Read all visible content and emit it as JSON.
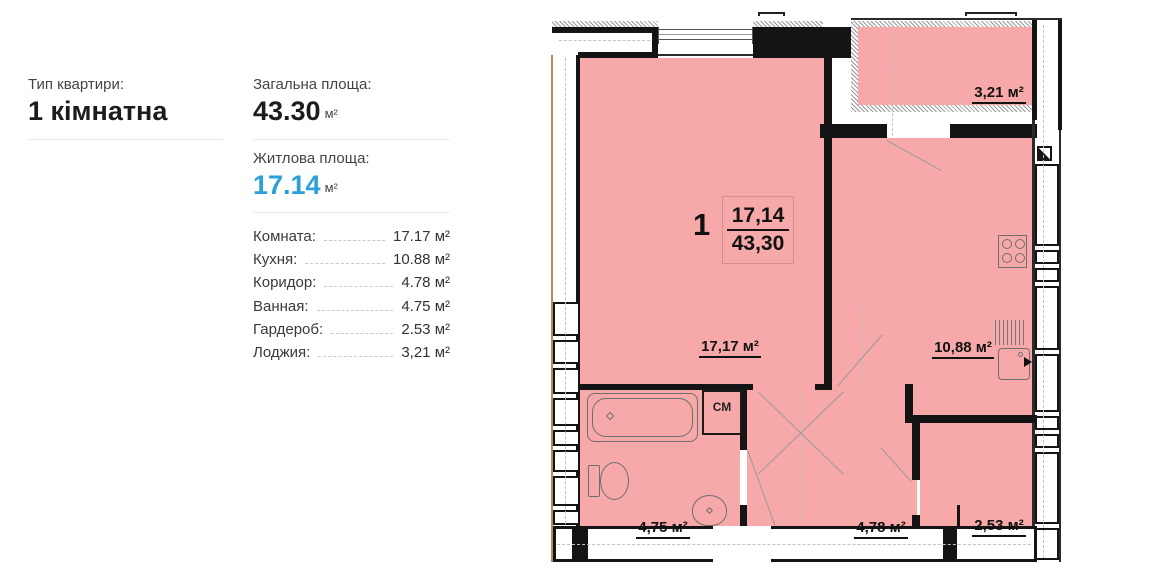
{
  "panel": {
    "type_label": "Тип квартири:",
    "type_value": "1 кімнатна",
    "total_label": "Загальна площа:",
    "total_value": "43.30",
    "total_unit": "м²",
    "living_label": "Житлова площа:",
    "living_value": "17.14",
    "living_unit": "м²",
    "living_color": "#2a9fd8",
    "rooms": [
      {
        "label": "Комната:",
        "value": "17.17 м²"
      },
      {
        "label": "Кухня:",
        "value": "10.88 м²"
      },
      {
        "label": "Коридор:",
        "value": "4.78 м²"
      },
      {
        "label": "Ванная:",
        "value": "4.75 м²"
      },
      {
        "label": "Гардероб:",
        "value": "2.53 м²"
      },
      {
        "label": "Лоджия:",
        "value": "3,21 м²"
      }
    ]
  },
  "plan": {
    "room_fill": "#f7a8a8",
    "wall_color": "#141414",
    "apartment_number": "1",
    "area_fraction": {
      "living": "17,14",
      "total": "43,30"
    },
    "labels": {
      "room": "17,17 м²",
      "kitchen": "10,88 м²",
      "loggia": "3,21 м²",
      "bathroom": "4,75 м²",
      "corridor": "4,78 м²",
      "wardrobe": "2,53 м²",
      "washing_machine": "СМ"
    }
  }
}
